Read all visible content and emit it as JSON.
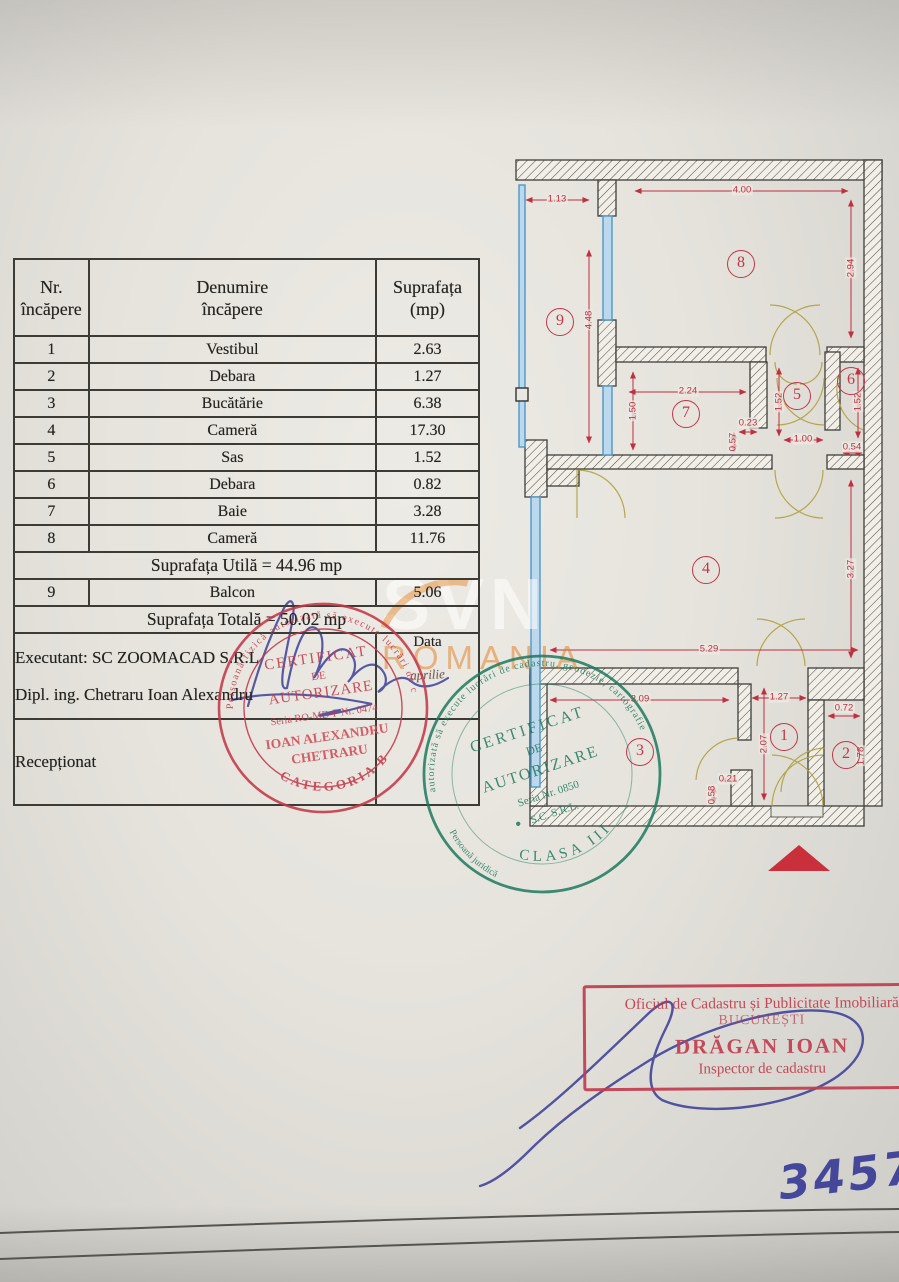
{
  "table": {
    "header": {
      "c1l1": "Nr.",
      "c1l2": "încăpere",
      "c2l1": "Denumire",
      "c2l2": "încăpere",
      "c3l1": "Suprafața",
      "c3l2": "(mp)"
    },
    "rows": [
      {
        "nr": "1",
        "name": "Vestibul",
        "area": "2.63"
      },
      {
        "nr": "2",
        "name": "Debara",
        "area": "1.27"
      },
      {
        "nr": "3",
        "name": "Bucătărie",
        "area": "6.38"
      },
      {
        "nr": "4",
        "name": "Cameră",
        "area": "17.30"
      },
      {
        "nr": "5",
        "name": "Sas",
        "area": "1.52"
      },
      {
        "nr": "6",
        "name": "Debara",
        "area": "0.82"
      },
      {
        "nr": "7",
        "name": "Baie",
        "area": "3.28"
      },
      {
        "nr": "8",
        "name": "Cameră",
        "area": "11.76"
      }
    ],
    "utila": "Suprafața Utilă = 44.96 mp",
    "balcon": {
      "nr": "9",
      "name": "Balcon",
      "area": "5.06"
    },
    "totala": "Suprafața Totală = 50.02 mp",
    "executant_line1": "Executant: SC ZOOMACAD S.R.L",
    "executant_line2": "Dipl. ing. Chetraru Ioan Alexandru",
    "data_label": "Data",
    "data_value": "aprilie",
    "receptionat": "Recepționat"
  },
  "plan": {
    "rooms": [
      {
        "n": "1",
        "x": 784,
        "y": 737
      },
      {
        "n": "2",
        "x": 846,
        "y": 755
      },
      {
        "n": "3",
        "x": 640,
        "y": 752
      },
      {
        "n": "4",
        "x": 706,
        "y": 570
      },
      {
        "n": "5",
        "x": 797,
        "y": 396
      },
      {
        "n": "6",
        "x": 851,
        "y": 381
      },
      {
        "n": "7",
        "x": 686,
        "y": 414
      },
      {
        "n": "8",
        "x": 741,
        "y": 264
      },
      {
        "n": "9",
        "x": 560,
        "y": 322
      }
    ],
    "dims": [
      {
        "v": "1.13",
        "x": 557,
        "y": 199,
        "r": 0
      },
      {
        "v": "4.48",
        "x": 589,
        "y": 320,
        "r": 1
      },
      {
        "v": "4.00",
        "x": 742,
        "y": 190,
        "r": 0
      },
      {
        "v": "2.94",
        "x": 851,
        "y": 268,
        "r": 1
      },
      {
        "v": "2.24",
        "x": 688,
        "y": 391,
        "r": 0
      },
      {
        "v": "1.50",
        "x": 633,
        "y": 411,
        "r": 1
      },
      {
        "v": "1.52",
        "x": 779,
        "y": 402,
        "r": 1
      },
      {
        "v": "0.23",
        "x": 748,
        "y": 423,
        "r": 0
      },
      {
        "v": "0.57",
        "x": 733,
        "y": 442,
        "r": 1
      },
      {
        "v": "1.00",
        "x": 803,
        "y": 439,
        "r": 0
      },
      {
        "v": "1.52",
        "x": 858,
        "y": 402,
        "r": 1
      },
      {
        "v": "0.54",
        "x": 852,
        "y": 447,
        "r": 0
      },
      {
        "v": "3.27",
        "x": 851,
        "y": 569,
        "r": 1
      },
      {
        "v": "5.29",
        "x": 709,
        "y": 649,
        "r": 0
      },
      {
        "v": "3.09",
        "x": 640,
        "y": 699,
        "r": 0
      },
      {
        "v": "1.27",
        "x": 779,
        "y": 697,
        "r": 0
      },
      {
        "v": "2.07",
        "x": 764,
        "y": 744,
        "r": 1
      },
      {
        "v": "0.72",
        "x": 844,
        "y": 708,
        "r": 0
      },
      {
        "v": "1.78",
        "x": 861,
        "y": 756,
        "r": 1
      },
      {
        "v": "0.21",
        "x": 728,
        "y": 779,
        "r": 0
      },
      {
        "v": "0.58",
        "x": 712,
        "y": 795,
        "r": 1
      }
    ]
  },
  "stamps": {
    "red_round": {
      "ring": "Persoană fizică autorizată să execute lucrări de cadastru",
      "l1": "CERTIFICAT",
      "l2": "DE",
      "l3": "AUTORIZARE",
      "l4": "Seria RO-MD-F Nr. 0474",
      "l5": "IOAN ALEXANDRU",
      "l6": "CHETRARU",
      "bottom": "CATEGORIA B"
    },
    "green_round": {
      "ring": "autorizată să execute lucrări de cadastru, geodezie, cartografie",
      "ring2": "Persoană juridică",
      "l1": "CERTIFICAT",
      "l2": "DE",
      "l3": "AUTORIZARE",
      "l4": "Seria    Nr. 0850",
      "l5": "S.C.      S.R.L.",
      "bottom": "CLASA III"
    },
    "office": {
      "l1": "Oficiul de Cadastru și Publicitate Imobiliară",
      "l2": "BUCUREȘTI",
      "l3": "DRĂGAN  IOAN",
      "l4": "Inspector de cadastru"
    }
  },
  "watermark": {
    "l1": "SVN",
    "l2": "ROMANIA"
  },
  "annotations": {
    "number": "3457"
  }
}
